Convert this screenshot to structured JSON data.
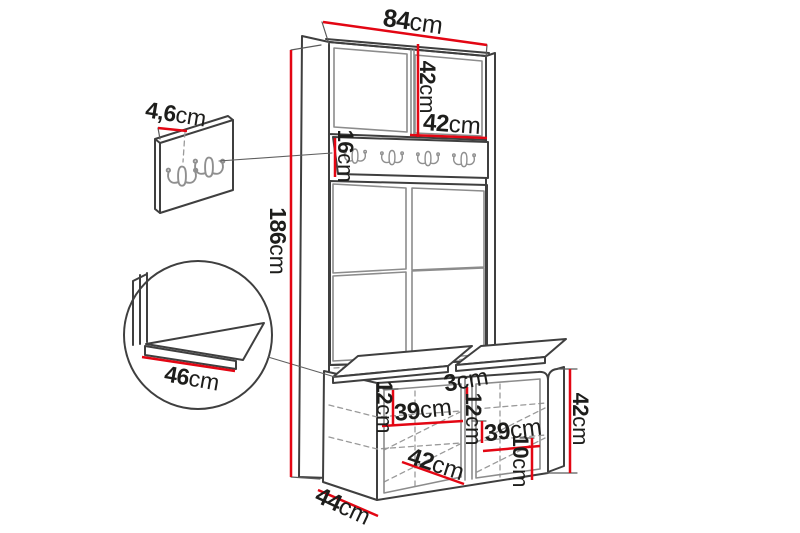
{
  "diagram": {
    "type": "furniture-dimension-drawing",
    "subject": "hallway unit with coat hook rail, upholstered panels and shoe bench",
    "unit": "cm",
    "colors": {
      "dimension_red": "#e30613",
      "outline_dark": "#3f3f3f",
      "outline_light": "#8c8c8c",
      "hook_gray": "#8f8f8f",
      "label_text": "#1d1d1b",
      "background": "#ffffff"
    },
    "hook_rail": {
      "hook_count": 4
    },
    "hook_panel_detail": {
      "hook_count": 2
    },
    "dimensions": {
      "total_width": {
        "num": "84",
        "unit": "cm"
      },
      "top_cabinet_height": {
        "num": "42",
        "unit": "cm"
      },
      "door_width": {
        "num": "42",
        "unit": "cm"
      },
      "hook_rail_height": {
        "num": "16",
        "unit": "cm"
      },
      "total_height": {
        "num": "186",
        "unit": "cm"
      },
      "panel_thickness": {
        "num": "4,6",
        "unit": "cm"
      },
      "seat_depth_detail": {
        "num": "46",
        "unit": "cm"
      },
      "bench_depth": {
        "num": "44",
        "unit": "cm"
      },
      "bench_height": {
        "num": "42",
        "unit": "cm"
      },
      "divider_thickness": {
        "num": "3",
        "unit": "cm"
      },
      "left_shelf_spacing": {
        "num": "12",
        "unit": "cm"
      },
      "left_compartment_width": {
        "num": "39",
        "unit": "cm"
      },
      "center_shelf_spacing": {
        "num": "12",
        "unit": "cm"
      },
      "right_compartment_width": {
        "num": "39",
        "unit": "cm"
      },
      "door_diagonal": {
        "num": "42",
        "unit": "cm"
      },
      "bottom_shelf_height": {
        "num": "10",
        "unit": "cm"
      }
    }
  }
}
